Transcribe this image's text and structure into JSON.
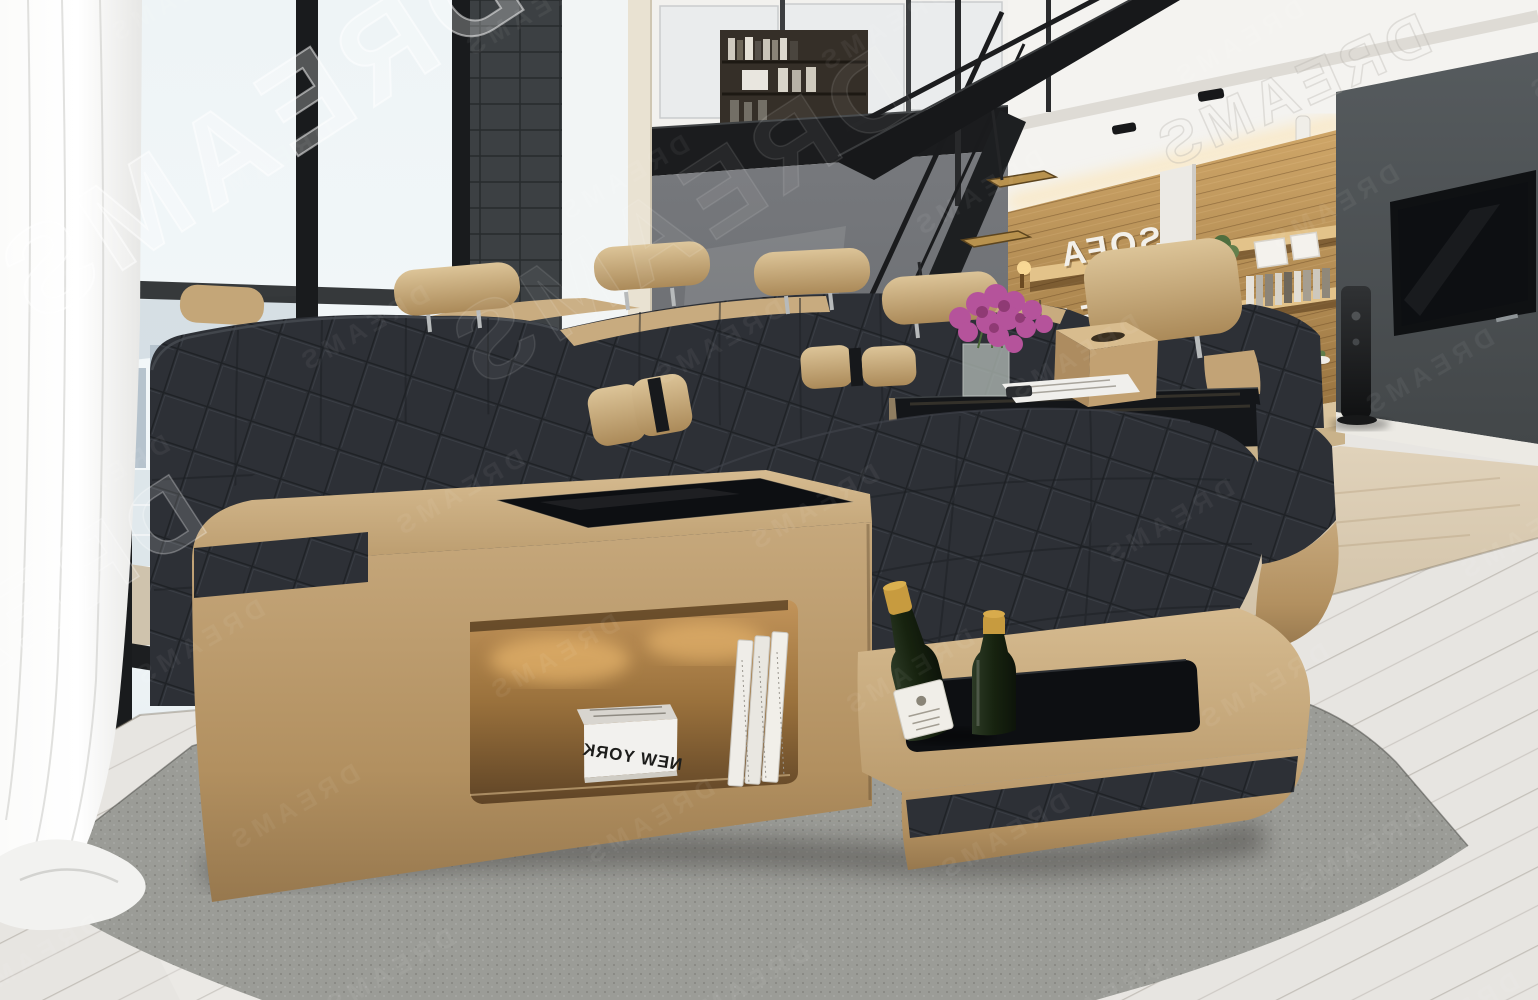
{
  "meta": {
    "title": "Loft living room with modern U-shaped sectional sofa",
    "image_type": "interior furniture product photograph (mirrored render)"
  },
  "watermark": {
    "text": "DREAMS",
    "style": "semi-transparent white outline letters, mirrored and rotated diagonally",
    "locations": [
      "top-left large",
      "left-center fragment",
      "faint repeated pattern over entire image"
    ]
  },
  "shelf_sign": {
    "line1": "SOFA",
    "line2": "DREAMS",
    "appearance": "white dimensional letters on wooden shelf wall, mirrored, partly hidden by sofa headrest"
  },
  "sofa": {
    "style": "modern U-shaped fabric sectional",
    "fabric": "dark charcoal quilted upholstery",
    "base": "sand-beige leather platform with black fabric inlay stripes",
    "headrest_count": 5,
    "lumbar_pillow_count": 4,
    "features": [
      "black glass insert tabletop",
      "illuminated open storage niche",
      "recessed serving tray with bottles"
    ]
  },
  "niche_books": {
    "flat_magazine_title": "NEW YORK",
    "upright_book_count": 3
  },
  "bottle_tray": {
    "bottle_count": 2,
    "description": "green glass bottles with gold foil tops, one with white label"
  },
  "coffee_table": {
    "surface": "black glass",
    "items": [
      "magenta bouquet in glass vase",
      "white magazine",
      "dark remote",
      "beige tissue box"
    ]
  },
  "background": {
    "left": "sheer white curtain, floor-to-ceiling windows, hazy city and water view",
    "center": "grey wall, mezzanine bookshelf, black steel staircase with wood treads",
    "right": "wood slat shelf wall with decor, dark grey media wall with flat TV and tower speaker",
    "floor": "whitewashed wide-plank floor with grey felt rug",
    "mezzanine": "black steel loft edge with glass balustrade"
  },
  "palette": {
    "leather_tan": "#c3a97d",
    "fabric_charcoal": "#2d3036",
    "wood_shelf": "#b08a52",
    "grey_wall": "#6b6e72",
    "tv_wall": "#4d5255",
    "stair_steel": "#1d1f21",
    "tread_wood": "#b8924e",
    "floor_plank": "#e7e5e1",
    "rug_grey": "#9b9c97",
    "flower_magenta": "#b5539b",
    "bottle_green": "#20301c",
    "foil_gold": "#c79b3f",
    "glass_black": "#0d0f12",
    "accent_warm_light": "#ffca7a"
  }
}
